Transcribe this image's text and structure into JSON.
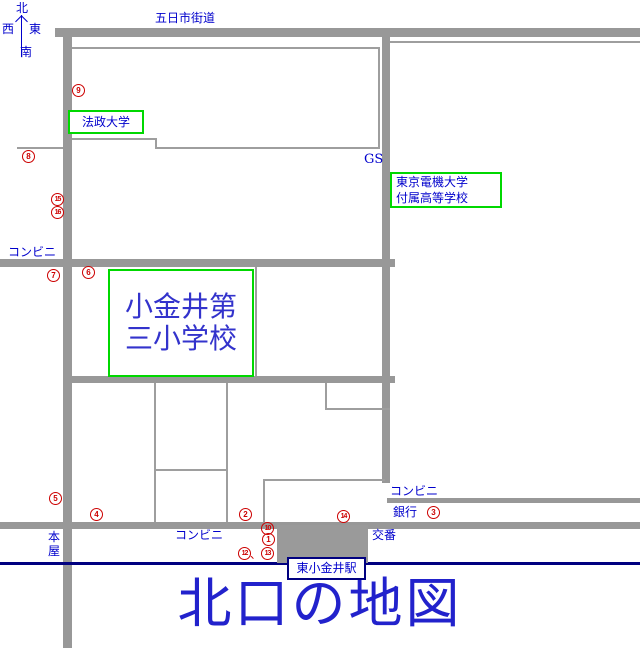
{
  "colors": {
    "text_blue": "#0000CC",
    "box_green": "#00D800",
    "marker_red": "#CC0000",
    "rail_navy": "#000080",
    "road_gray": "#989898"
  },
  "compass": {
    "north": "北",
    "west": "西",
    "east": "東",
    "south": "南"
  },
  "roads": {
    "itsukaichi_kaido": "五日市街道"
  },
  "labels": {
    "gas_station": "GS",
    "convenience_left": "コンビニ",
    "convenience_center": "コンビニ",
    "convenience_right": "コンビニ",
    "bookstore": "本屋",
    "bank": "銀行",
    "police_box": "交番"
  },
  "places": {
    "hosei_university": "法政大学",
    "denki_university_hs": {
      "line1": "東京電機大学",
      "line2": "付属高等学校"
    },
    "koganei_daisan_elementary": {
      "line1": "小金井第",
      "line2": "三小学校"
    }
  },
  "station": {
    "name": "東小金井駅"
  },
  "title": "北口の地図",
  "markers": {
    "m1": "1",
    "m2": "2",
    "m3": "3",
    "m4": "4",
    "m5": "5",
    "m6": "6",
    "m7": "7",
    "m8": "8",
    "m9": "9",
    "m10": "10",
    "m12": "12",
    "m13": "13",
    "m14": "14",
    "m15": "15",
    "m16": "16"
  },
  "markers_separator": "、"
}
